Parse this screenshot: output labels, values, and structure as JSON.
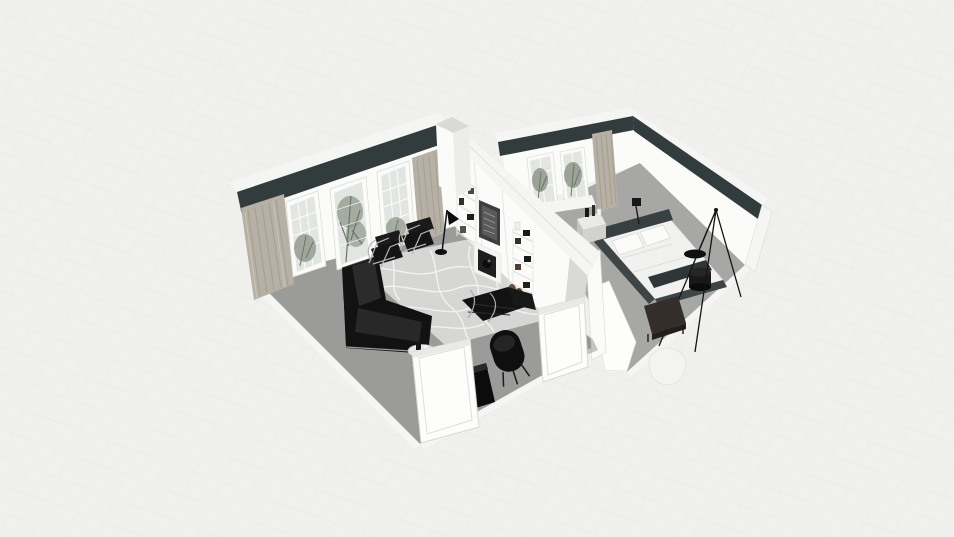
{
  "canvas": {
    "label": "3D dollhouse floor-plan render of a two-room apartment"
  },
  "scene": {
    "rooms": [
      {
        "label": "Living room",
        "items": [
          "sectional-sofa",
          "wassily-chair",
          "wassily-chair",
          "barcelona-daybed",
          "armchair",
          "media-cabinet",
          "wire-side-table",
          "floor-lamp",
          "area-rug",
          "fireplace",
          "framed-art",
          "built-in-shelves",
          "windows-with-plants",
          "curtains",
          "open-doors"
        ]
      },
      {
        "label": "Bedroom",
        "items": [
          "double-bed",
          "headboard",
          "pillows",
          "nightstand",
          "table-lamp",
          "round-side-table",
          "tripod-floor-lamp",
          "foot-bench",
          "fur-rug",
          "window-with-plants",
          "curtain"
        ]
      }
    ]
  },
  "colors": {
    "bg": "#f0f0ee",
    "bg-line": "#e7e7e5",
    "wall-white": "#fbfbfa",
    "wall-top": "#f5f5f3",
    "wall-shade": "#ececea",
    "wall-edge": "#d8d8d6",
    "accent-band": "#333c3d",
    "floor-living": "#9b9b99",
    "floor-bedroom": "#a7a7a5",
    "rug": "#d6d6d4",
    "rug-vein": "#f5f5f3",
    "glass": "#e2e5e1",
    "plant": "#8f978b",
    "plant-dark": "#6e756a",
    "curtain": "#b7b0a4",
    "curtain-dark": "#9d968a",
    "black-furniture": "#121212",
    "black-highlight": "#2b2b2b",
    "chrome": "#b3b3b1",
    "bed-frame": "#3e4546",
    "bedding": "#f1f1ef",
    "pillow": "#fbfbfa",
    "throw": "#2f3638",
    "bench-wood": "#332e29",
    "boot-brown": "#6a4f3c",
    "door": "#fdfdfc",
    "shadow": "#8f8f8d"
  }
}
